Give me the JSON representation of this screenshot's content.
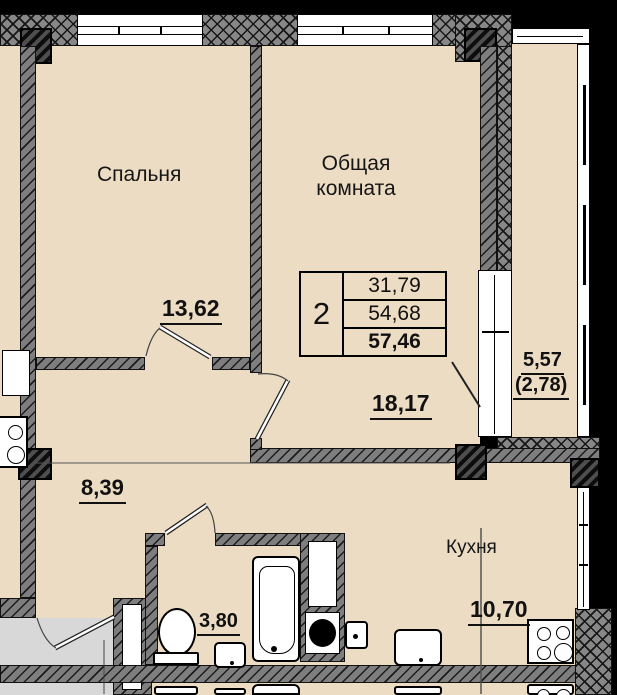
{
  "labels": {
    "bedroom": "Спальня",
    "living_line1": "Общая",
    "living_line2": "комната",
    "kitchen": "Кухня"
  },
  "areas": {
    "bedroom": "13,62",
    "living": "18,17",
    "hallway": "8,39",
    "bathroom": "3,80",
    "kitchen": "10,70",
    "balcony": "5,57",
    "balcony_reduced": "(2,78)"
  },
  "info_box": {
    "room_count": "2",
    "rows": [
      "31,79",
      "54,68",
      "57,46"
    ]
  },
  "colors": {
    "floor": "#ecdcc3",
    "wall_gray": "#7e7e7e",
    "column_dark": "#3a3a3a",
    "outside": "#000000",
    "stairwell": "#d8d8d8"
  }
}
